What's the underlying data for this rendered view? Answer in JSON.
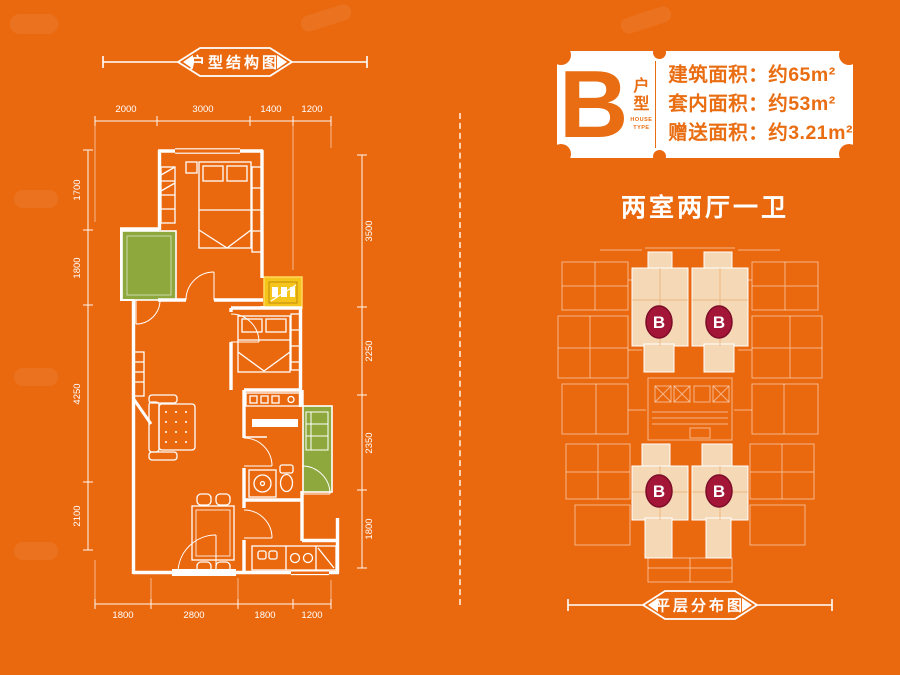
{
  "page": {
    "background_color": "#ea690f",
    "wall_color": "#ffffff",
    "balcony_color": "#8fa83e",
    "bay_window_color": "#f6c51c"
  },
  "left_panel": {
    "ribbon_title": "户型结构图",
    "dimensions": {
      "top": [
        "2000",
        "3000",
        "1400",
        "1200"
      ],
      "bottom": [
        "1800",
        "2800",
        "1800",
        "1200"
      ],
      "left": [
        "1700",
        "1800",
        "4250",
        "2100"
      ],
      "right": [
        "3500",
        "2250",
        "2350",
        "1800"
      ]
    }
  },
  "right_panel": {
    "type_badge": {
      "letter": "B",
      "type_label_cn_1": "户",
      "type_label_cn_2": "型",
      "type_label_en_1": "HOUSE",
      "type_label_en_2": "TYPE",
      "accent_color": "#e96d12",
      "specs": [
        "建筑面积：约65m²",
        "套内面积：约53m²",
        "赠送面积：约3.21m²"
      ]
    },
    "layout_summary": "两室两厅一卫",
    "floor_plate": {
      "unit_marker": "B",
      "marker_color": "#a31638",
      "highlight_color": "#f5d9b6",
      "marker_count": 4
    },
    "ribbon_title": "平层分布图"
  }
}
